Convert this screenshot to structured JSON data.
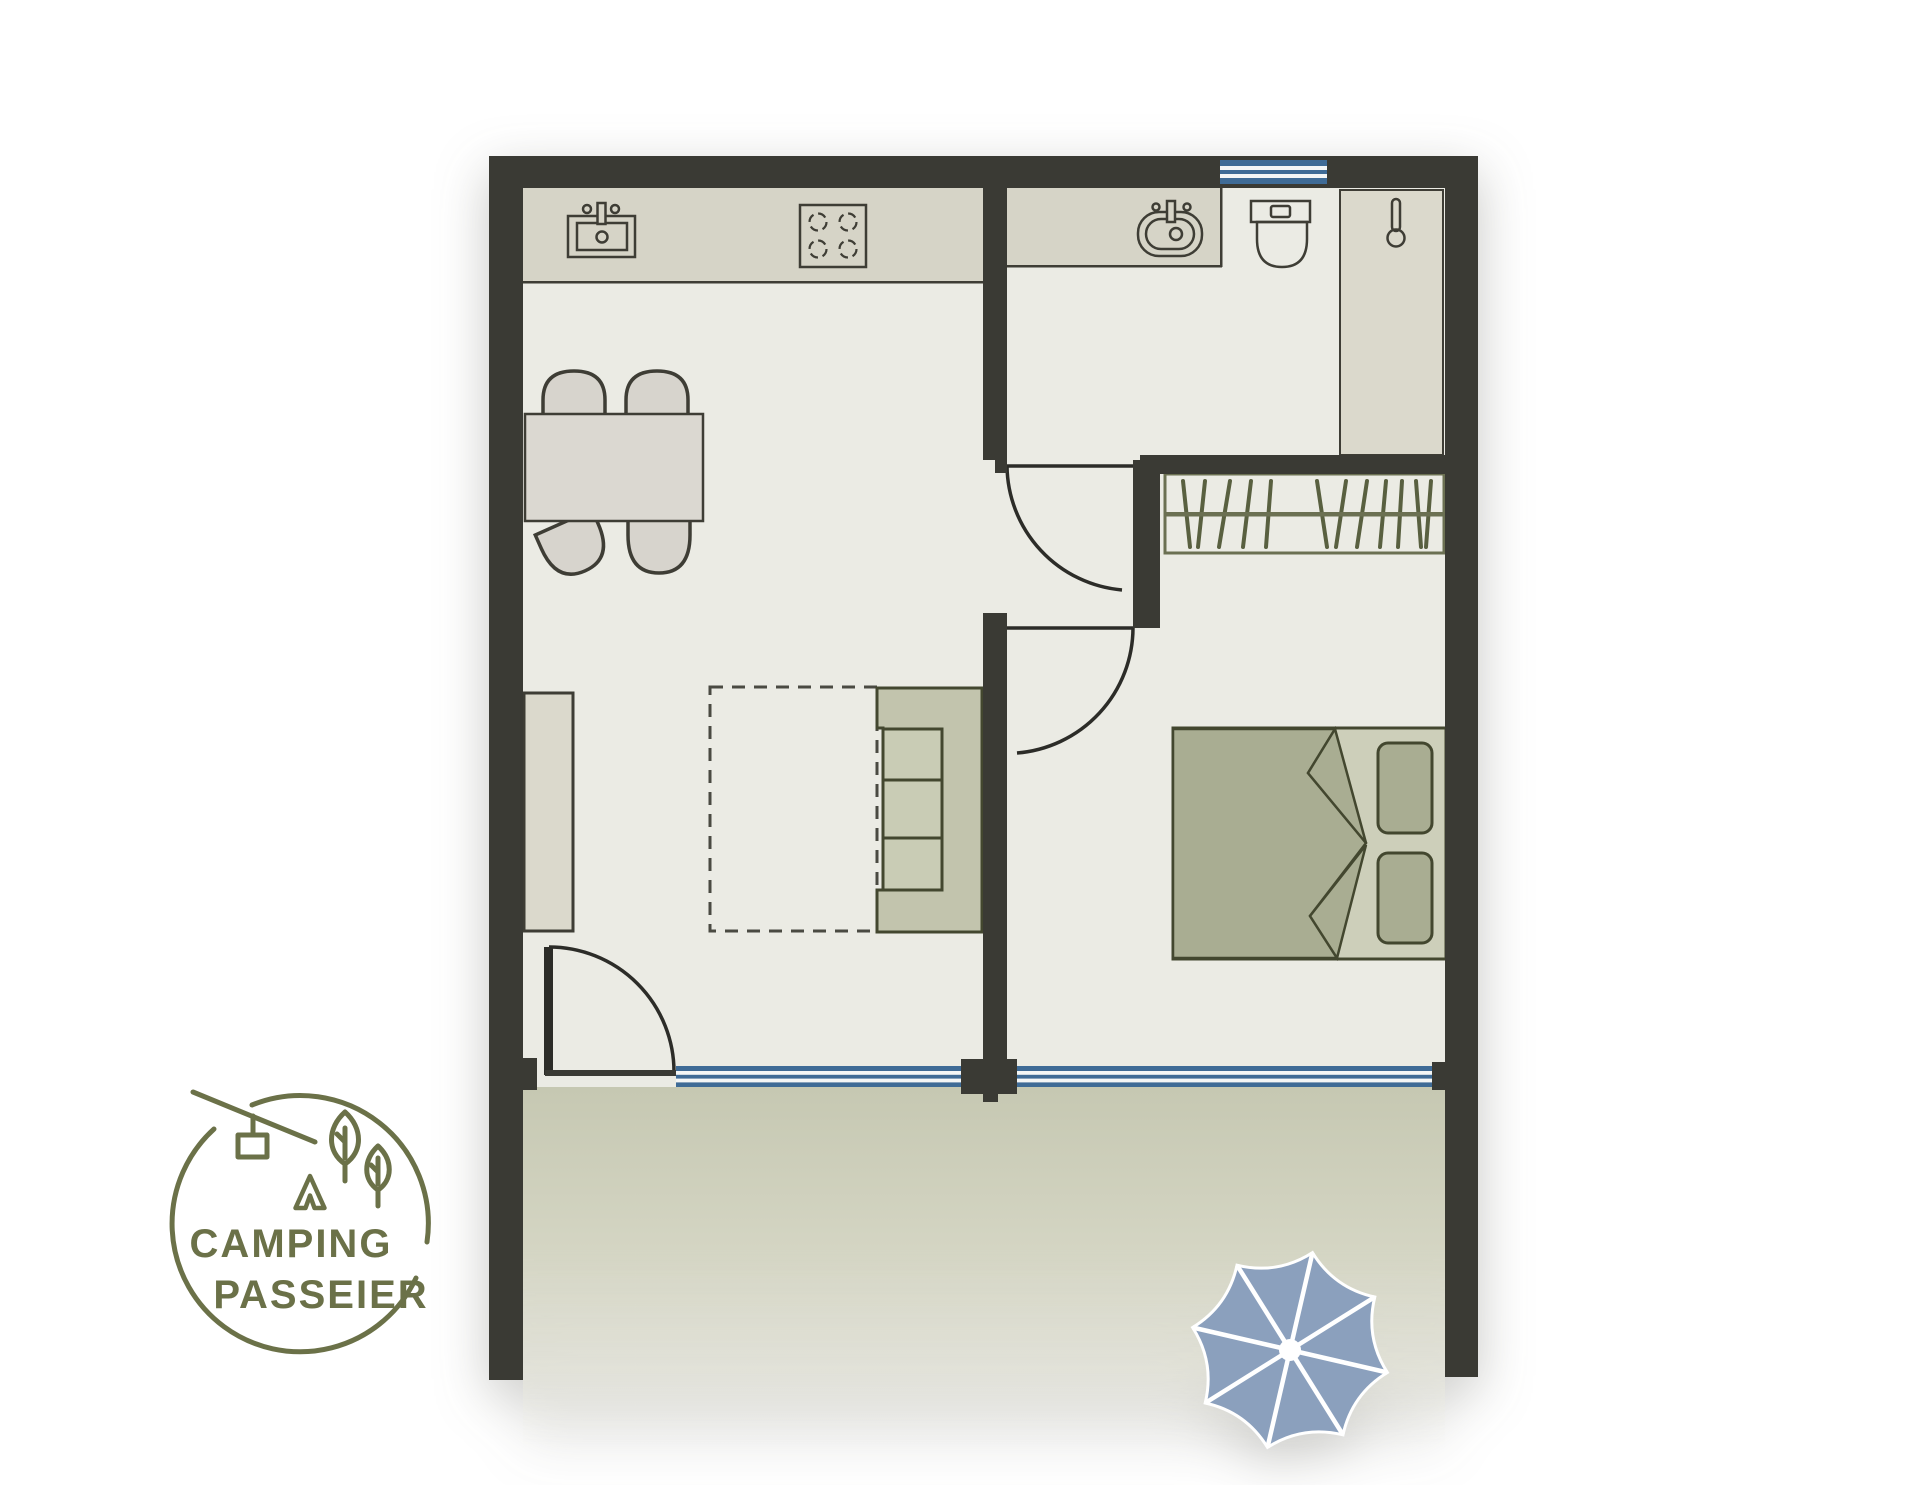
{
  "brand": {
    "line1": "CAMPING",
    "line2": "PASSEIER"
  },
  "floorplan": {
    "rooms": [
      "kitchen-living-room",
      "bathroom",
      "hallway",
      "bedroom",
      "terrace"
    ],
    "fixtures": [
      "kitchen-sink",
      "stove",
      "dining-table",
      "four-chairs",
      "sideboard",
      "sofa",
      "sofa-bed-extension-dashed",
      "bathroom-sink",
      "toilet",
      "shower-column",
      "wardrobe-rail",
      "double-bed",
      "two-pillows",
      "parasol"
    ],
    "windows": 2,
    "doors": 3
  },
  "icons": [
    "kitchen-sink-icon",
    "stove-icon",
    "bathroom-sink-icon",
    "toilet-icon",
    "thermometer-icon",
    "clothes-rail-icon",
    "umbrella-icon",
    "cable-car-icon",
    "tree-icon",
    "tent-icon"
  ],
  "colors": {
    "wall": "#3a3a34",
    "floor": "#ebebe4",
    "counter": "#d6d4c7",
    "column": "#dbd9cc",
    "furniture": "#d7d4cd",
    "tablefill": "#dbd8d1",
    "outline": "#3e3d35",
    "door": "#2c2c28",
    "oliveborder": "#6b7052",
    "olivedark": "#596040",
    "sofa": "#c2c4ad",
    "cushion": "#c9ccb5",
    "bedlight": "#cdcfba",
    "beddark": "#a9ad92",
    "winblue": "#3f6b96",
    "winwhite": "#f4f6f6",
    "terrace": "#c6c8b2",
    "umbrella": "#8ba0bd",
    "logo": "#6b7148"
  }
}
